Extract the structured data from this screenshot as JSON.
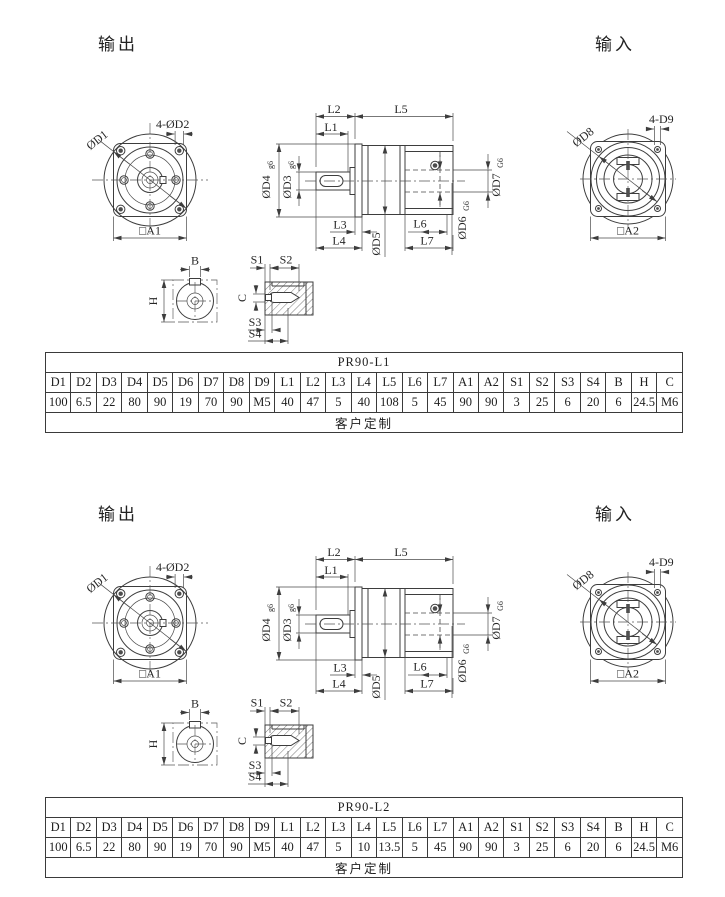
{
  "sections": [
    {
      "output_label": "输出",
      "input_label": "输入",
      "table": {
        "title": "PR90-L1",
        "headers": [
          "D1",
          "D2",
          "D3",
          "D4",
          "D5",
          "D6",
          "D7",
          "D8",
          "D9",
          "L1",
          "L2",
          "L3",
          "L4",
          "L5",
          "L6",
          "L7",
          "A1",
          "A2",
          "S1",
          "S2",
          "S3",
          "S4",
          "B",
          "H",
          "C"
        ],
        "values": [
          "100",
          "6.5",
          "22",
          "80",
          "90",
          "19",
          "70",
          "90",
          "M5",
          "40",
          "47",
          "5",
          "40",
          "108",
          "5",
          "45",
          "90",
          "90",
          "3",
          "25",
          "6",
          "20",
          "6",
          "24.5",
          "M6"
        ],
        "note": "客户定制"
      }
    },
    {
      "output_label": "输出",
      "input_label": "输入",
      "table": {
        "title": "PR90-L2",
        "headers": [
          "D1",
          "D2",
          "D3",
          "D4",
          "D5",
          "D6",
          "D7",
          "D8",
          "D9",
          "L1",
          "L2",
          "L3",
          "L4",
          "L5",
          "L6",
          "L7",
          "A1",
          "A2",
          "S1",
          "S2",
          "S3",
          "S4",
          "B",
          "H",
          "C"
        ],
        "values": [
          "100",
          "6.5",
          "22",
          "80",
          "90",
          "19",
          "70",
          "90",
          "M5",
          "40",
          "47",
          "5",
          "10",
          "13.5",
          "5",
          "45",
          "90",
          "90",
          "3",
          "25",
          "6",
          "20",
          "6",
          "24.5",
          "M6"
        ],
        "note": "客户定制"
      }
    }
  ],
  "dim": {
    "d1": "ØD1",
    "d2_holes": "4-ØD2",
    "a1": "□A1",
    "l1": "L1",
    "l2": "L2",
    "l3": "L3",
    "l4": "L4",
    "l5": "L5",
    "l6": "L6",
    "l7": "L7",
    "d3": "ØD3",
    "d4": "ØD4",
    "d5": "ØD5",
    "d6": "ØD6",
    "d7": "ØD7",
    "fit_g6": "g6",
    "fit_G6": "G6",
    "d8": "ØD8",
    "d9_holes": "4-D9",
    "a2": "□A2",
    "b": "B",
    "h": "H",
    "c": "C",
    "s1": "S1",
    "s2": "S2",
    "s3": "S3",
    "s4": "S4"
  }
}
